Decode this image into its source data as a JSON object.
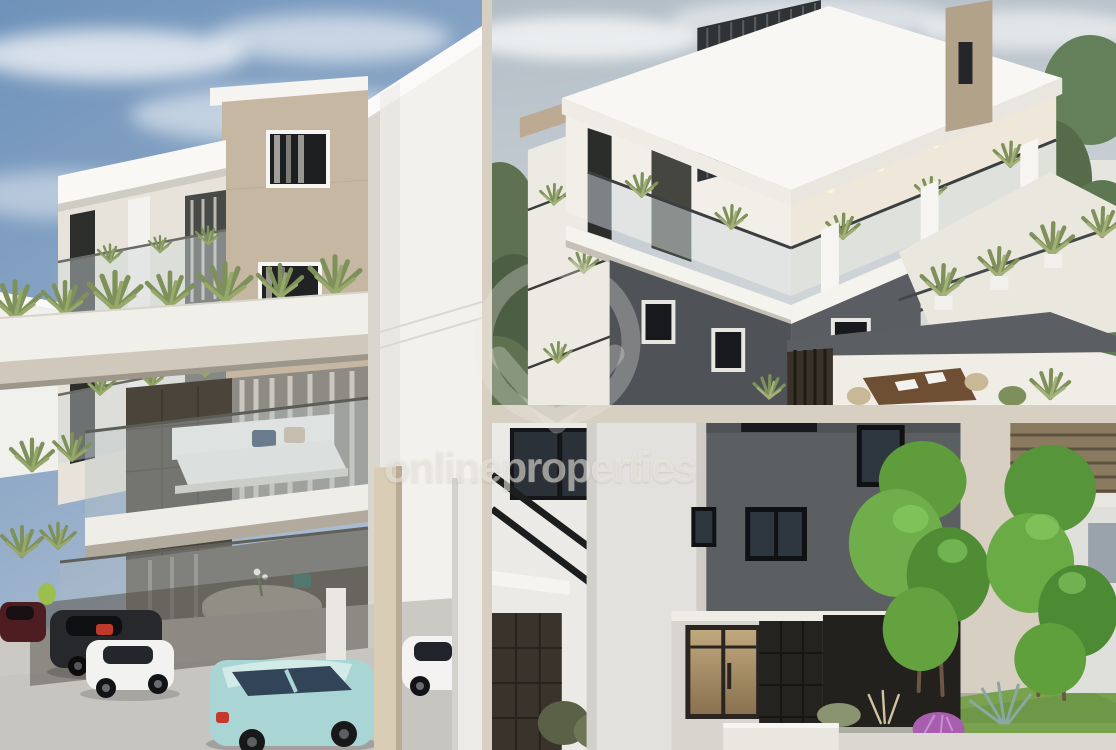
{
  "page": {
    "type": "property-photo-collage",
    "width_px": 1116,
    "height_px": 750,
    "background_color": "#d6cfc2"
  },
  "watermark": {
    "text": "onlineproperties",
    "text_color": "rgba(240,238,232,0.55)",
    "logo": "map-pin-ring",
    "logo_color": "rgba(238,235,227,0.30)"
  },
  "collage": {
    "layout": "one tall panel left, two stacked panels right",
    "gap_color": "#d6cfc2",
    "panels": [
      {
        "position": "left",
        "description": "Street-level 3D rendering of a modern three-storey apartment building with white and tan facades, glass balconies, agave planters, a round rattan dining set and covered ground-floor parking with five cars"
      },
      {
        "position": "top-right",
        "description": "Elevated 3D rendering of the apartment building showing white frame structure, dark vertical louvres, glass balconies with plants, a roof terrace with agave planters and surrounding green trees"
      },
      {
        "position": "bottom-right",
        "description": "3D rendering of the building entrance courtyard with dark grey facade, bronze glass entrance door, dark stone walls, bright green trees, lawn and a purple ornamental bush"
      }
    ]
  },
  "palette": {
    "sky_blue": "#7b9cc2",
    "sky_pale": "#c0cad1",
    "building_white": "#f3f1ed",
    "building_tan": "#c6b7a2",
    "building_dark_grey": "#54575b",
    "stone_dark": "#3a332b",
    "plant_green": "#7e915a",
    "tree_green": "#5f9c3c",
    "grass_green": "#79a24e",
    "car_teal": "#a9d6d4",
    "car_white": "#f2f2f0",
    "car_maroon": "#5e2026",
    "door_bronze": "#a3875f",
    "flower_purple": "#a760ad"
  }
}
